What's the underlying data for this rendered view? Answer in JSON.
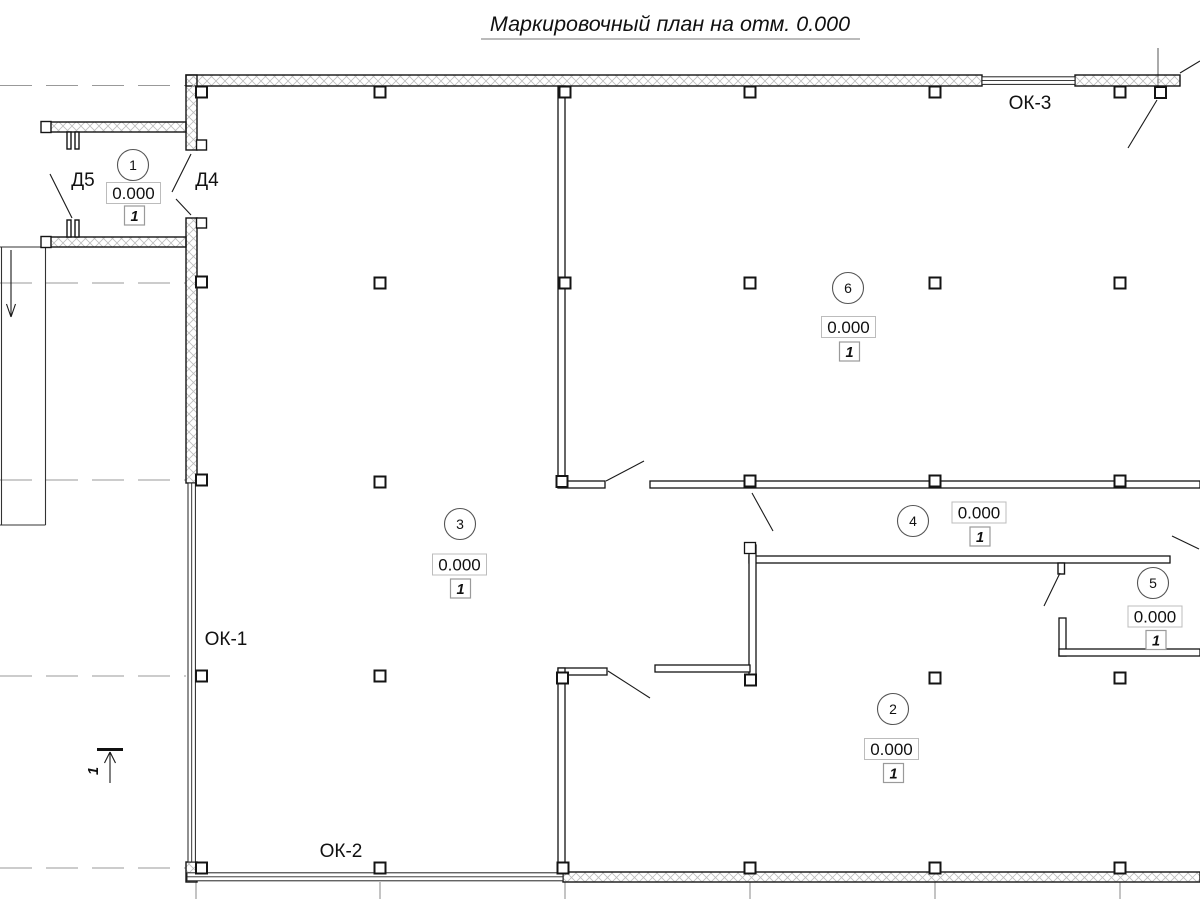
{
  "title": "Маркировочный план на отм. 0.000",
  "openings": {
    "ok1": "ОК-1",
    "ok2": "ОК-2",
    "ok3": "ОК-3",
    "d4": "Д4",
    "d5": "Д5"
  },
  "section": {
    "label": "1"
  },
  "rooms": [
    {
      "number": "1",
      "elevation": "0.000",
      "finish_mark": "1",
      "cx": 133,
      "cy": 165,
      "ex": 133.5,
      "ey": 193,
      "kx": 134.5,
      "ky": 215.5
    },
    {
      "number": "3",
      "elevation": "0.000",
      "finish_mark": "1",
      "cx": 460,
      "cy": 524,
      "ex": 459.5,
      "ey": 564.5,
      "kx": 460.5,
      "ky": 588.5
    },
    {
      "number": "6",
      "elevation": "0.000",
      "finish_mark": "1",
      "cx": 848,
      "cy": 288,
      "ex": 848.5,
      "ey": 327,
      "kx": 849.5,
      "ky": 351.5
    },
    {
      "number": "4",
      "elevation": "0.000",
      "finish_mark": "1",
      "cx": 913,
      "cy": 521,
      "ex": 979,
      "ey": 512.5,
      "kx": 980,
      "ky": 536.5
    },
    {
      "number": "5",
      "elevation": "0.000",
      "finish_mark": "1",
      "cx": 1153,
      "cy": 583,
      "ex": 1155,
      "ey": 616.5,
      "kx": 1156,
      "ky": 640
    },
    {
      "number": "2",
      "elevation": "0.000",
      "finish_mark": "1",
      "cx": 893,
      "cy": 709,
      "ex": 891.5,
      "ey": 749,
      "kx": 893.5,
      "ky": 773
    }
  ]
}
